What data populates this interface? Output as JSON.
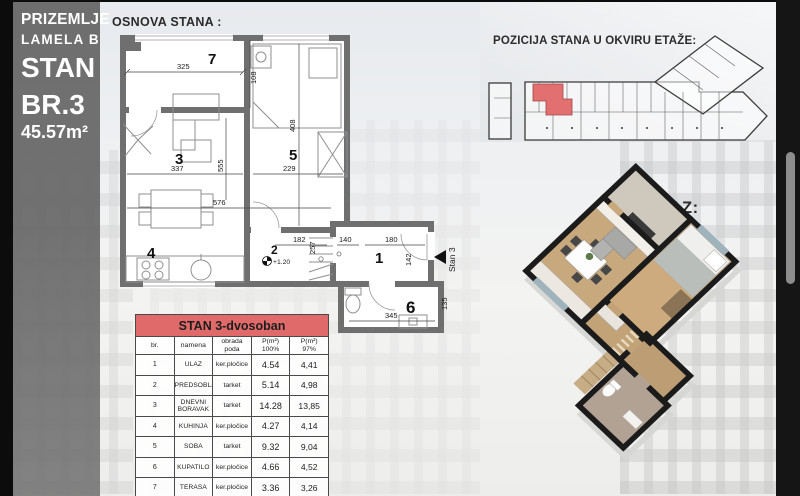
{
  "sidebar": {
    "floor_label": "PRIZEMLJE",
    "lamela_label": "LAMELA B",
    "unit_line1": "STAN",
    "unit_line2": "BR.3",
    "area_label": "45.57m²"
  },
  "headers": {
    "floor_plan": "OSNOVA STANA :",
    "position": "POZICIJA STANA U OKVIRU ETAŽE:",
    "render_3d": "3D PRIKAZ:"
  },
  "floor_plan": {
    "entry_label": "Stan 3",
    "level_label": "+1.20",
    "rooms": {
      "r1": "1",
      "r2": "2",
      "r3": "3",
      "r4": "4",
      "r5": "5",
      "r6": "6",
      "r7": "7"
    },
    "dims": {
      "w325": "325",
      "h108": "108",
      "w337": "337",
      "w229": "229",
      "h408": "408",
      "h555": "555",
      "w576": "576",
      "w182": "182",
      "h257": "257",
      "w140": "140",
      "w180": "180",
      "h142": "142",
      "w345": "345",
      "h135": "135"
    }
  },
  "table": {
    "title": "STAN  3-dvosoban",
    "col_br": "br.",
    "col_namena": "namena",
    "col_obrada": "obrada poda",
    "col_p100_line1": "P(m²)",
    "col_p100_line2": "100%",
    "col_p97_line1": "P(m²)",
    "col_p97_line2": "97%",
    "rows": [
      {
        "br": "1",
        "namena": "ULAZ",
        "obrada": "ker.pločice",
        "p100": "4.54",
        "p97": "4,41"
      },
      {
        "br": "2",
        "namena": "PREDSOBLJE",
        "obrada": "tarket",
        "p100": "5.14",
        "p97": "4,98"
      },
      {
        "br": "3",
        "namena": "DNEVNI BORAVAK",
        "obrada": "tarket",
        "p100": "14.28",
        "p97": "13,85"
      },
      {
        "br": "4",
        "namena": "KUHINJA",
        "obrada": "ker.pločice",
        "p100": "4.27",
        "p97": "4,14"
      },
      {
        "br": "5",
        "namena": "SOBA",
        "obrada": "tarket",
        "p100": "9.32",
        "p97": "9,04"
      },
      {
        "br": "6",
        "namena": "KUPATILO",
        "obrada": "ker.pločice",
        "p100": "4.66",
        "p97": "4,52"
      },
      {
        "br": "7",
        "namena": "TERASA",
        "obrada": "ker.pločice",
        "p100": "3.36",
        "p97": "3,26"
      },
      {
        "br": "",
        "namena": "UKUPNO NETO",
        "obrada": "",
        "p100": "45.57",
        "p97": "44.20"
      }
    ]
  },
  "colors": {
    "highlight_red": "#e06a6a",
    "lamela_red": "#c23b3b",
    "plan_wall_gray": "#6f6f6f",
    "render_wall_black": "#1a1a1a"
  }
}
